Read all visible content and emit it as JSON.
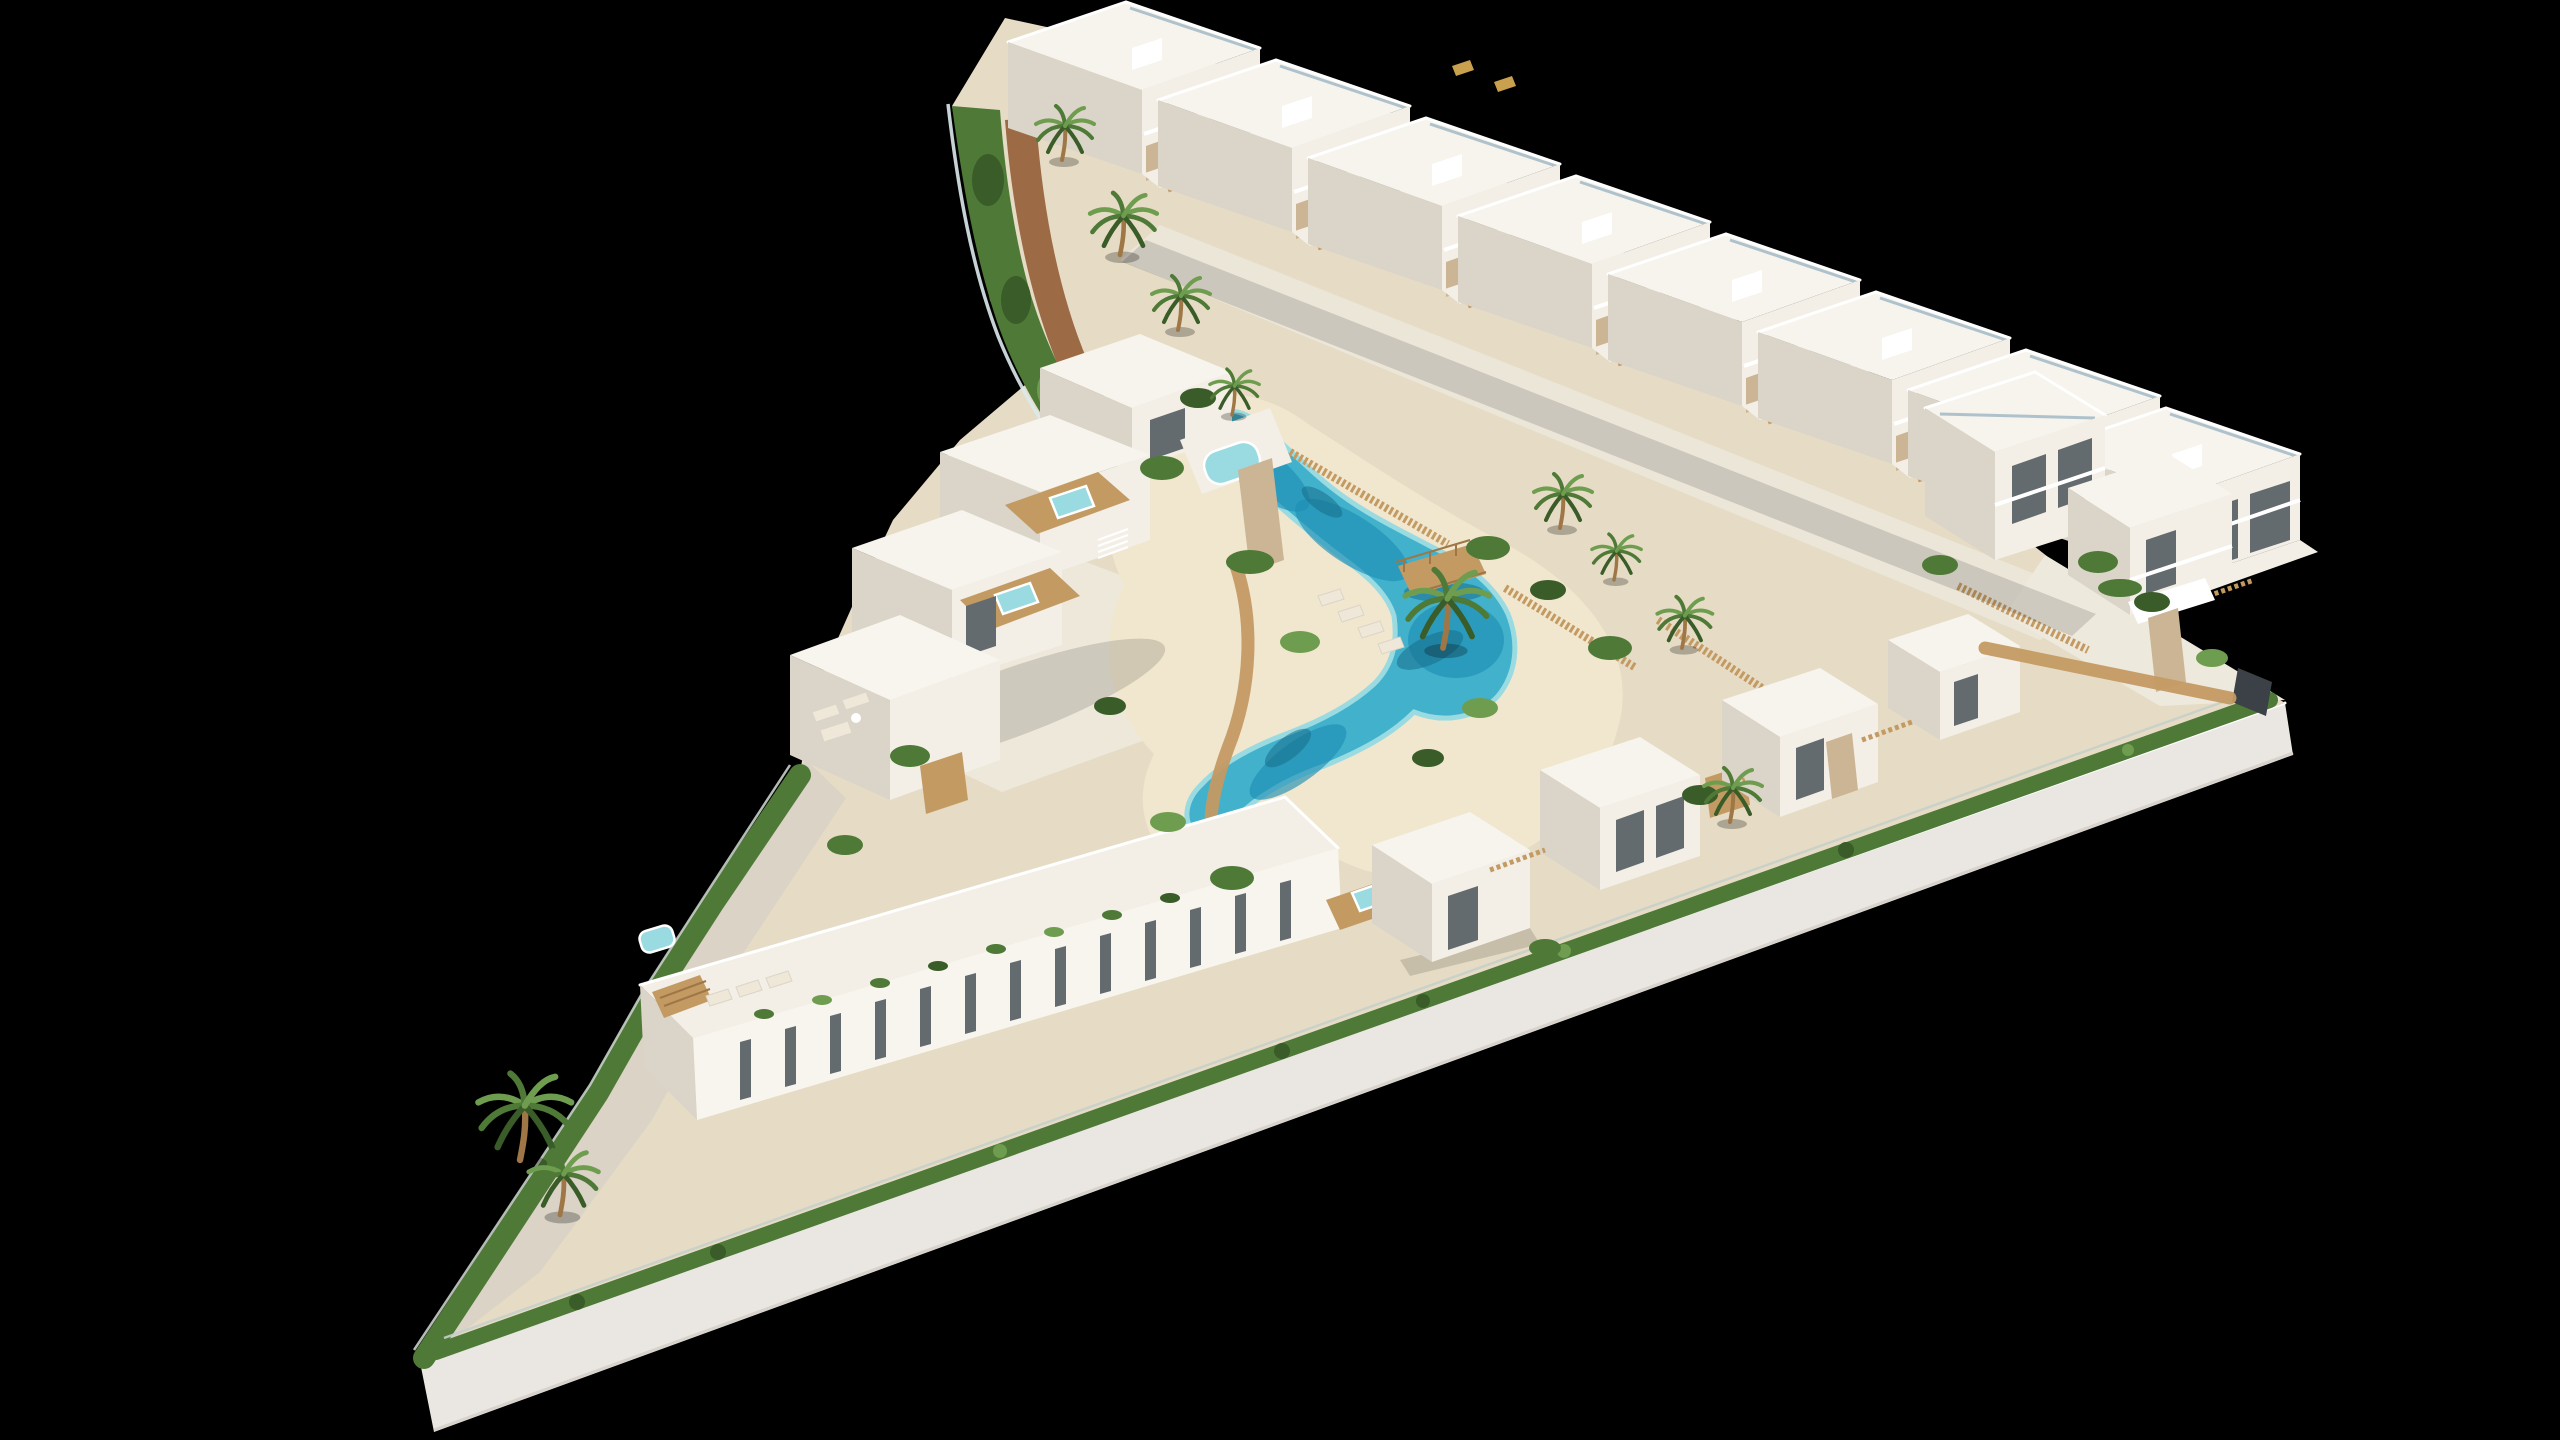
{
  "image": {
    "type": "3d-architectural-aerial-render",
    "background_color": "#000000",
    "description": "Aerial 3D render of a triangular coastal residential development: white Mediterranean flat-roof buildings arranged around a winding lagoon-style communal pool with sandy beach edges, wooden footbridge, palm trees, hedged perimeter and a white retaining wall, all on a black background"
  },
  "site": {
    "shape": "triangular wedge, tip pointing bottom-left",
    "perimeter": {
      "retaining_wall": "tall white wall along the bottom edge",
      "fences": [
        "glass balustrade along curved upper-left edge",
        "wire mesh fence above bottom wall",
        "dark metal gate at right tip"
      ],
      "hedges": "continuous green hedge bands along all edges"
    }
  },
  "pool": {
    "style": "free-form lagoon with sandy beach edges",
    "water_colors": [
      "#9adbe2",
      "#41b1cc",
      "#1f8fb4"
    ],
    "features": [
      "wooden footbridge with railings",
      "palm on beach peninsula",
      "sun loungers on beach",
      "timber slat fencing along both sides",
      "timber walkway on west side"
    ]
  },
  "buildings": {
    "style": "white Mediterranean flat-roof with stone accents and timber details",
    "top_row_townhouses": {
      "count": 8,
      "features": [
        "textured gravel flat roofs",
        "glass roof railings",
        "balconies",
        "stone ground piers",
        "front patios with timber fences",
        "roof stair bulkheads"
      ]
    },
    "left_cluster": {
      "count": 4,
      "features": [
        "rooftop timber decks",
        "hot tubs",
        "roof stairs",
        "rubble-stone tower",
        "outdoor lounge furniture",
        "timber slat screens"
      ]
    },
    "bottom_apartment_block": {
      "count": 1,
      "features": [
        "narrow vertical slit windows",
        "roof terrace with sun loungers",
        "timber pergola",
        "roof-edge planters"
      ]
    },
    "center_villas": {
      "count": 4,
      "features": [
        "hot tub decks",
        "stone planter columns",
        "timber privacy fences",
        "textured roofs"
      ]
    },
    "right_cluster": {
      "count": 2,
      "features": [
        "glass balconies",
        "entrance canopy",
        "stone pillar",
        "timber walkway to gate"
      ]
    }
  },
  "landscape": {
    "palm_trees": 11,
    "hedge_bushes": "clusters between plots and along pool beach",
    "dirt_path": "curved red-earth path along upper-left hedge",
    "ground_colors": {
      "sand": "#e6dcc5",
      "beach": "#f1e7ce",
      "paving": "#eee9dd",
      "gravel": "#dad3c6",
      "dirt_path": "#9c6a45"
    }
  },
  "palette": {
    "bg": "#000000",
    "wall": "#eae7e2",
    "wallEdge": "#d7d3cc",
    "sand": "#e6dcc5",
    "beach": "#f1e7ce",
    "paving": "#eee9dd",
    "pavingL": "#f3efe6",
    "gravel": "#dad3c6",
    "dirt": "#9c6a45",
    "dirtLight": "#b3835a",
    "hedge": "#4e7937",
    "hedgeDark": "#3a5c28",
    "hedgeLight": "#6f9d4f",
    "poolMain": "#41b1cc",
    "poolDeep": "#1f8fb4",
    "poolLight": "#9adbe2",
    "poolShadow": "#176d8a",
    "wood": "#c49a63",
    "woodLight": "#dcba8a",
    "woodDark": "#9f7747",
    "stone": "#ccb594",
    "roofTex": "#f6f4ed",
    "face": "#f3efe7",
    "faceShade": "#dbd4c8",
    "faceBright": "#f8f5ef",
    "window": "#646b6f",
    "railGlass": "#a2b9c4",
    "fenceWire": "#c7cfc8",
    "fenceGlass": "#dce9ec",
    "gate": "#3b4146",
    "white": "#ffffff",
    "shadowCol": "#00000022",
    "furn": "#efe8d8",
    "gold": "#c9a14e"
  }
}
